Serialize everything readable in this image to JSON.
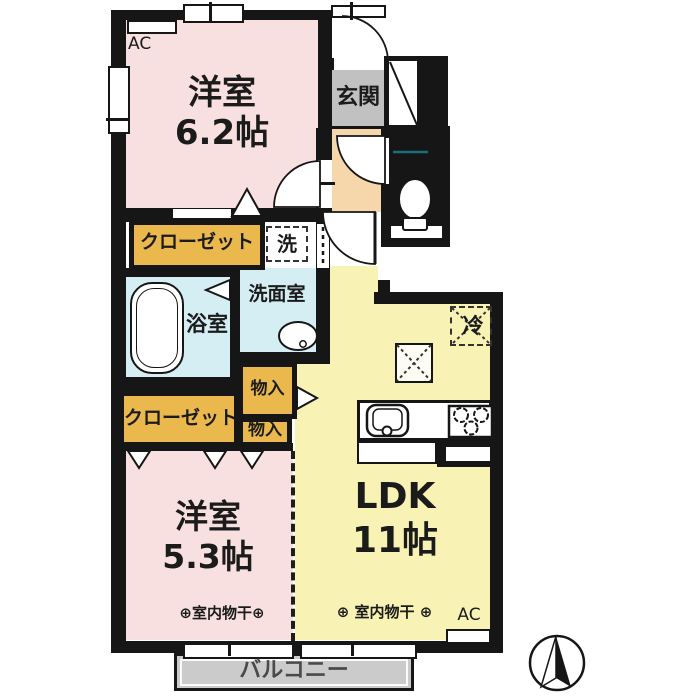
{
  "rooms": {
    "bedroom_top": {
      "name": "洋室",
      "size": "6.2帖"
    },
    "bedroom_bottom": {
      "name": "洋室",
      "size": "5.3帖"
    },
    "ldk": {
      "name": "LDK",
      "size": "11帖"
    },
    "entrance": {
      "label": "玄関"
    },
    "bathroom": {
      "label": "浴室"
    },
    "washroom": {
      "label": "洗面室"
    },
    "washer_space": {
      "label": "洗"
    },
    "closet_upper": {
      "label": "クローゼット"
    },
    "closet_lower": {
      "label": "クローゼット"
    },
    "storage_upper": {
      "label": "物入"
    },
    "storage_lower": {
      "label": "物入"
    },
    "refrigerator": {
      "label": "冷"
    },
    "balcony": {
      "label": "バルコニー"
    }
  },
  "annotations": {
    "ac_top": "AC",
    "ac_bottom": "AC",
    "drying_left": "⊕室内物干⊕",
    "drying_right": "⊕ 室内物干 ⊕"
  },
  "colors": {
    "wall": "#161616",
    "bedroom_pink": "#f8e0e0",
    "ldk_yellow": "#f8f3b4",
    "closet_orange": "#ebb84d",
    "hall_peach": "#f5d7ab",
    "wet_area_blue": "#d5eef3",
    "entrance_gray": "#c1c1c1",
    "balcony_gray": "#cbcbcb"
  }
}
